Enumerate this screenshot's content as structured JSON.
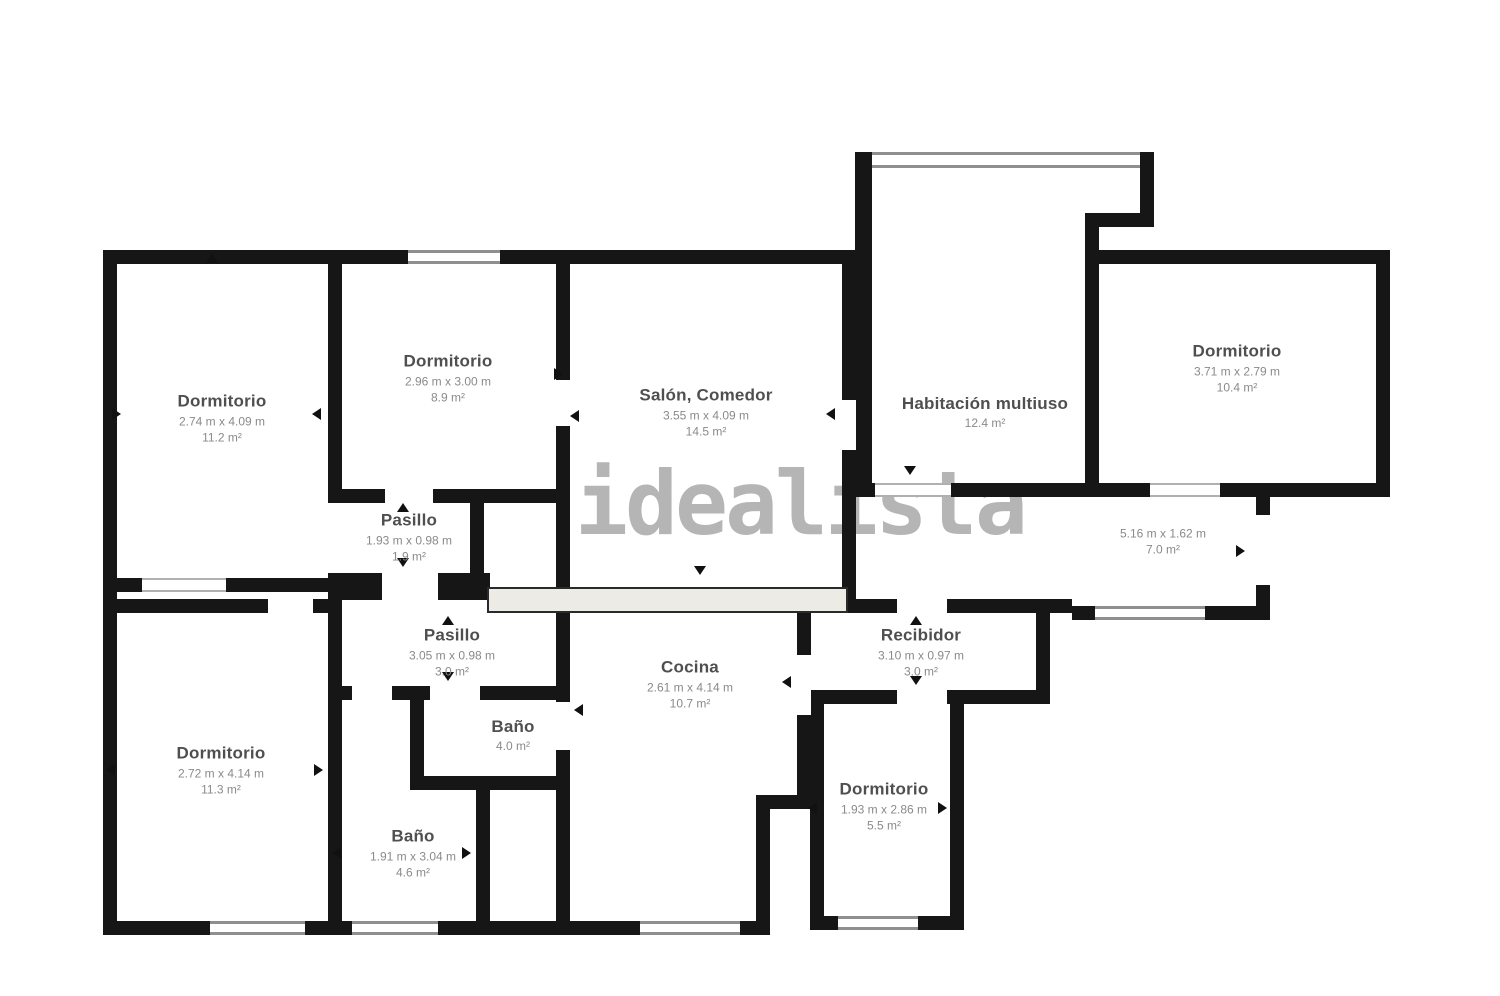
{
  "watermark": "idealista",
  "colors": {
    "wall": "#161616",
    "room_name": "#4f4f4f",
    "room_dims": "#8a8a8a",
    "watermark": "#b5b5b5",
    "window_line": "#8f8f8f",
    "beam_fill": "#edebe6"
  },
  "rooms": [
    {
      "id": "bedroom-top-left",
      "name": "Dormitorio",
      "dims": "2.74 m x 4.09 m",
      "area": "11.2 m²"
    },
    {
      "id": "bedroom-top-2",
      "name": "Dormitorio",
      "dims": "2.96 m x 3.00 m",
      "area": "8.9 m²"
    },
    {
      "id": "living-dining",
      "name": "Salón, Comedor",
      "dims": "3.55 m x 4.09 m",
      "area": "14.5 m²"
    },
    {
      "id": "multipurpose-room",
      "name": "Habitación multiuso",
      "area": "12.4 m²"
    },
    {
      "id": "bedroom-top-right",
      "name": "Dormitorio",
      "dims": "3.71 m x 2.79 m",
      "area": "10.4 m²"
    },
    {
      "id": "corridor-right",
      "dims": "5.16 m x 1.62 m",
      "area": "7.0 m²"
    },
    {
      "id": "hallway-upper",
      "name": "Pasillo",
      "dims": "1.93 m x 0.98 m",
      "area": "1.9 m²"
    },
    {
      "id": "hallway-lower",
      "name": "Pasillo",
      "dims": "3.05 m x 0.98 m",
      "area": "3.0 m²"
    },
    {
      "id": "kitchen",
      "name": "Cocina",
      "dims": "2.61 m x 4.14 m",
      "area": "10.7 m²"
    },
    {
      "id": "entry-hall",
      "name": "Recibidor",
      "dims": "3.10 m x 0.97 m",
      "area": "3.0 m²"
    },
    {
      "id": "bedroom-bottom-left",
      "name": "Dormitorio",
      "dims": "2.72 m x 4.14 m",
      "area": "11.3 m²"
    },
    {
      "id": "bathroom-upper",
      "name": "Baño",
      "area": "4.0 m²"
    },
    {
      "id": "bathroom-lower",
      "name": "Baño",
      "dims": "1.91 m x 3.04 m",
      "area": "4.6 m²"
    },
    {
      "id": "bedroom-bottom",
      "name": "Dormitorio",
      "dims": "1.93 m x 2.86 m",
      "area": "5.5 m²"
    }
  ]
}
